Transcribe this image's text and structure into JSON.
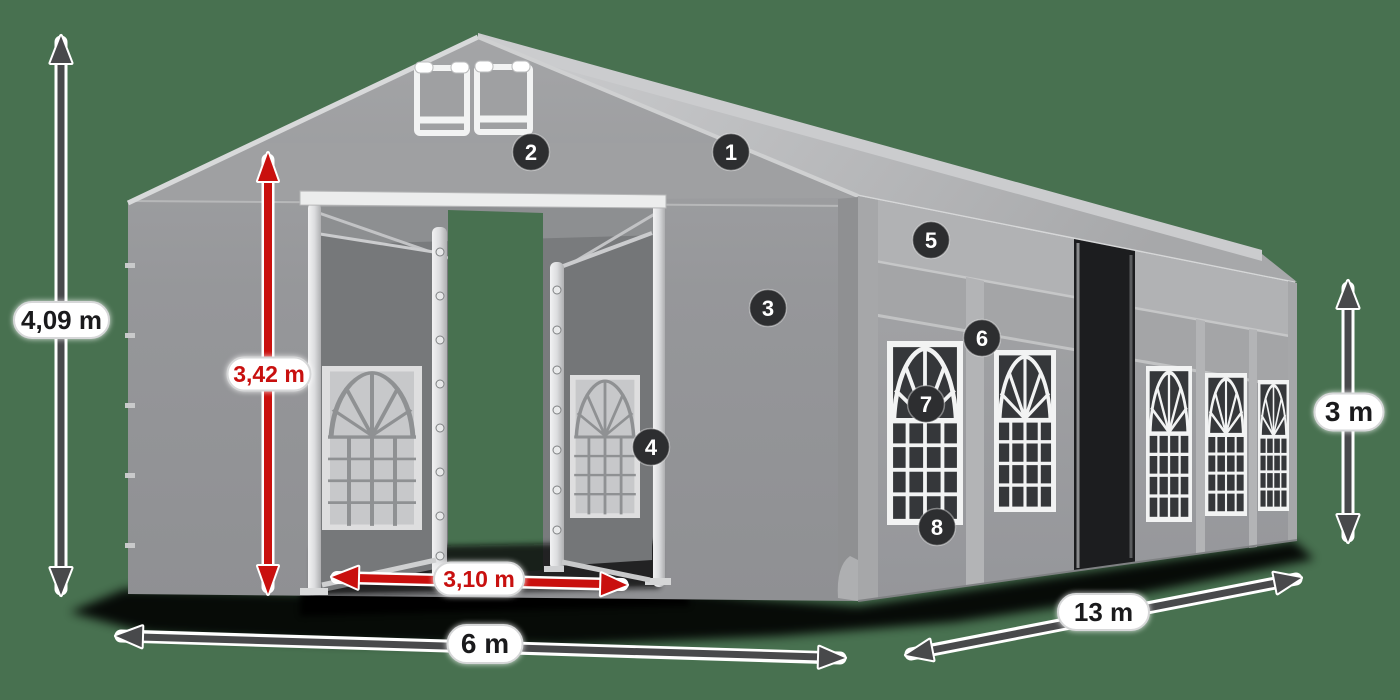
{
  "diagram": {
    "title": "party-tent-dimensions-diagram",
    "background_color": "#487150",
    "colors": {
      "tent_gray": "#9A9B9D",
      "roof_light": "#C6C7C9",
      "door_gray": "#76787A",
      "window_dark": "#35373A",
      "frame_white": "#F2F3F3",
      "dark_arrow": "#48494B",
      "red_arrow": "#C9100E",
      "badge_bg": "#2D2E30",
      "pill_bg": "#FFFFFF",
      "label_dark": "#1A1A1C",
      "label_red": "#C8100F"
    },
    "dimensions": [
      {
        "id": "total-height",
        "label": "4,09 m",
        "style": "dark",
        "orientation": "vertical"
      },
      {
        "id": "entrance-height",
        "label": "3,42 m",
        "style": "red",
        "orientation": "vertical"
      },
      {
        "id": "entrance-width",
        "label": "3,10 m",
        "style": "red",
        "orientation": "horizontal"
      },
      {
        "id": "front-width",
        "label": "6 m",
        "style": "dark",
        "orientation": "horizontal"
      },
      {
        "id": "side-length",
        "label": "13 m",
        "style": "dark",
        "orientation": "diagonal"
      },
      {
        "id": "side-height",
        "label": "3 m",
        "style": "dark",
        "orientation": "vertical"
      }
    ],
    "callouts": [
      {
        "label": "1"
      },
      {
        "label": "2"
      },
      {
        "label": "3"
      },
      {
        "label": "4"
      },
      {
        "label": "5"
      },
      {
        "label": "6"
      },
      {
        "label": "7"
      },
      {
        "label": "8"
      }
    ]
  }
}
